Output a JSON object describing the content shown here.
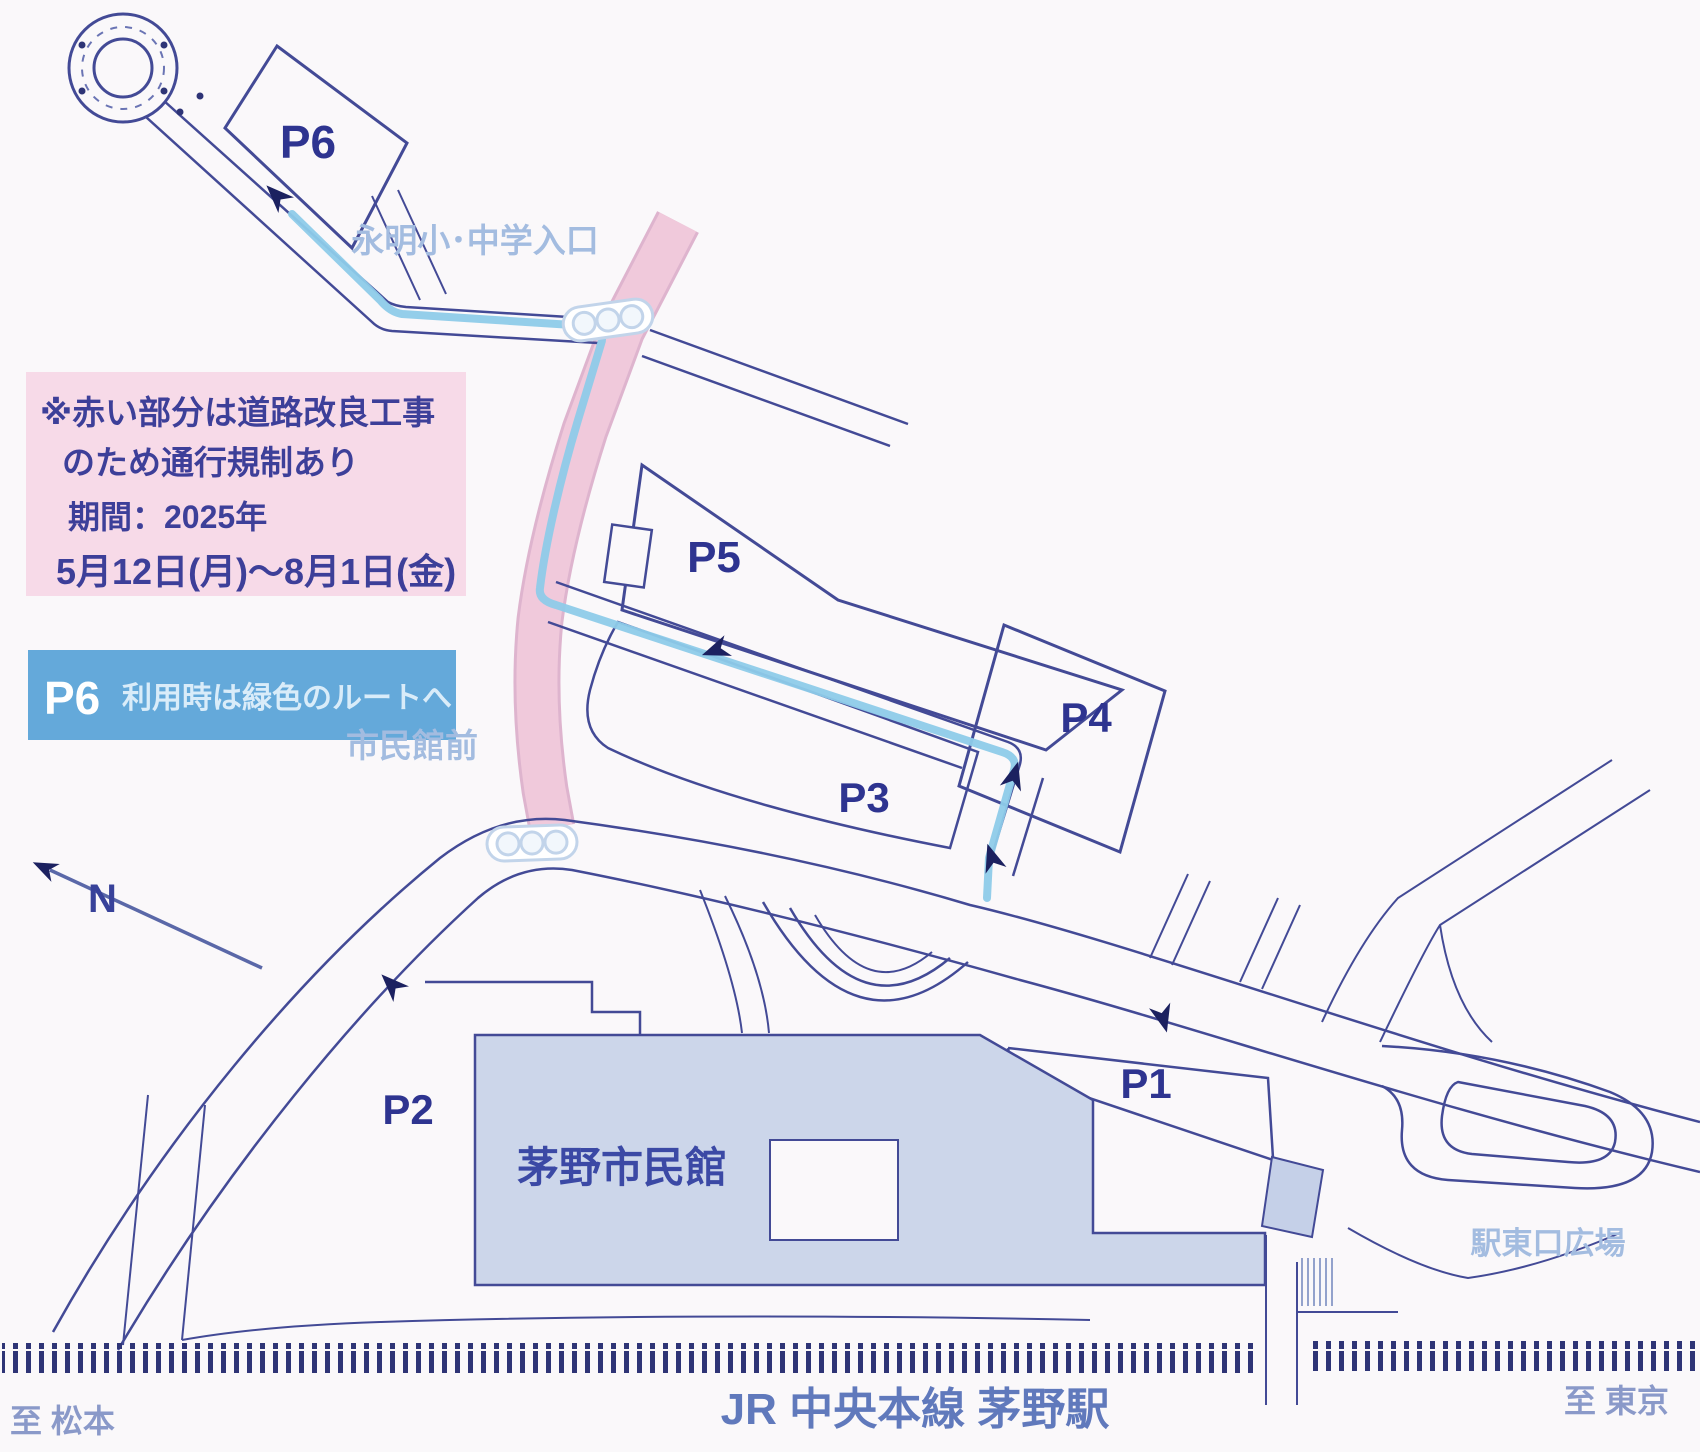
{
  "map": {
    "construction_notice": {
      "line1": "※赤い部分は道路改良工事",
      "line2": "のため通行規制あり",
      "line3": "期間：2025年",
      "line4": "5月12日(月)～8月1日(金)"
    },
    "banner": {
      "p6": "P6",
      "text": "利用時は緑色のルートへ"
    },
    "parking": [
      {
        "id": "P1",
        "label": "P1"
      },
      {
        "id": "P2",
        "label": "P2"
      },
      {
        "id": "P3",
        "label": "P3"
      },
      {
        "id": "P4",
        "label": "P4"
      },
      {
        "id": "P5",
        "label": "P5"
      },
      {
        "id": "P6",
        "label": "P6"
      }
    ],
    "landmarks": {
      "hall": "茅野市民館",
      "station_plaza": "駅東口広場",
      "railway": "JR 中央本線 茅野駅",
      "intersection_north": "永明小･中学入口",
      "intersection_hall": "市民館前",
      "to_west": "至 松本",
      "to_east": "至 東京",
      "compass_north": "N"
    },
    "colors": {
      "road_line": "#434a96",
      "route_blue": "#8ecbe9",
      "construction_pink": "#f0c9db",
      "construction_edge": "#c67ba9",
      "notice_bg": "#f7dae8",
      "banner_bg": "#64a9da",
      "building_fill": "#ccd6ea",
      "rail_tick": "#2e3476"
    }
  }
}
